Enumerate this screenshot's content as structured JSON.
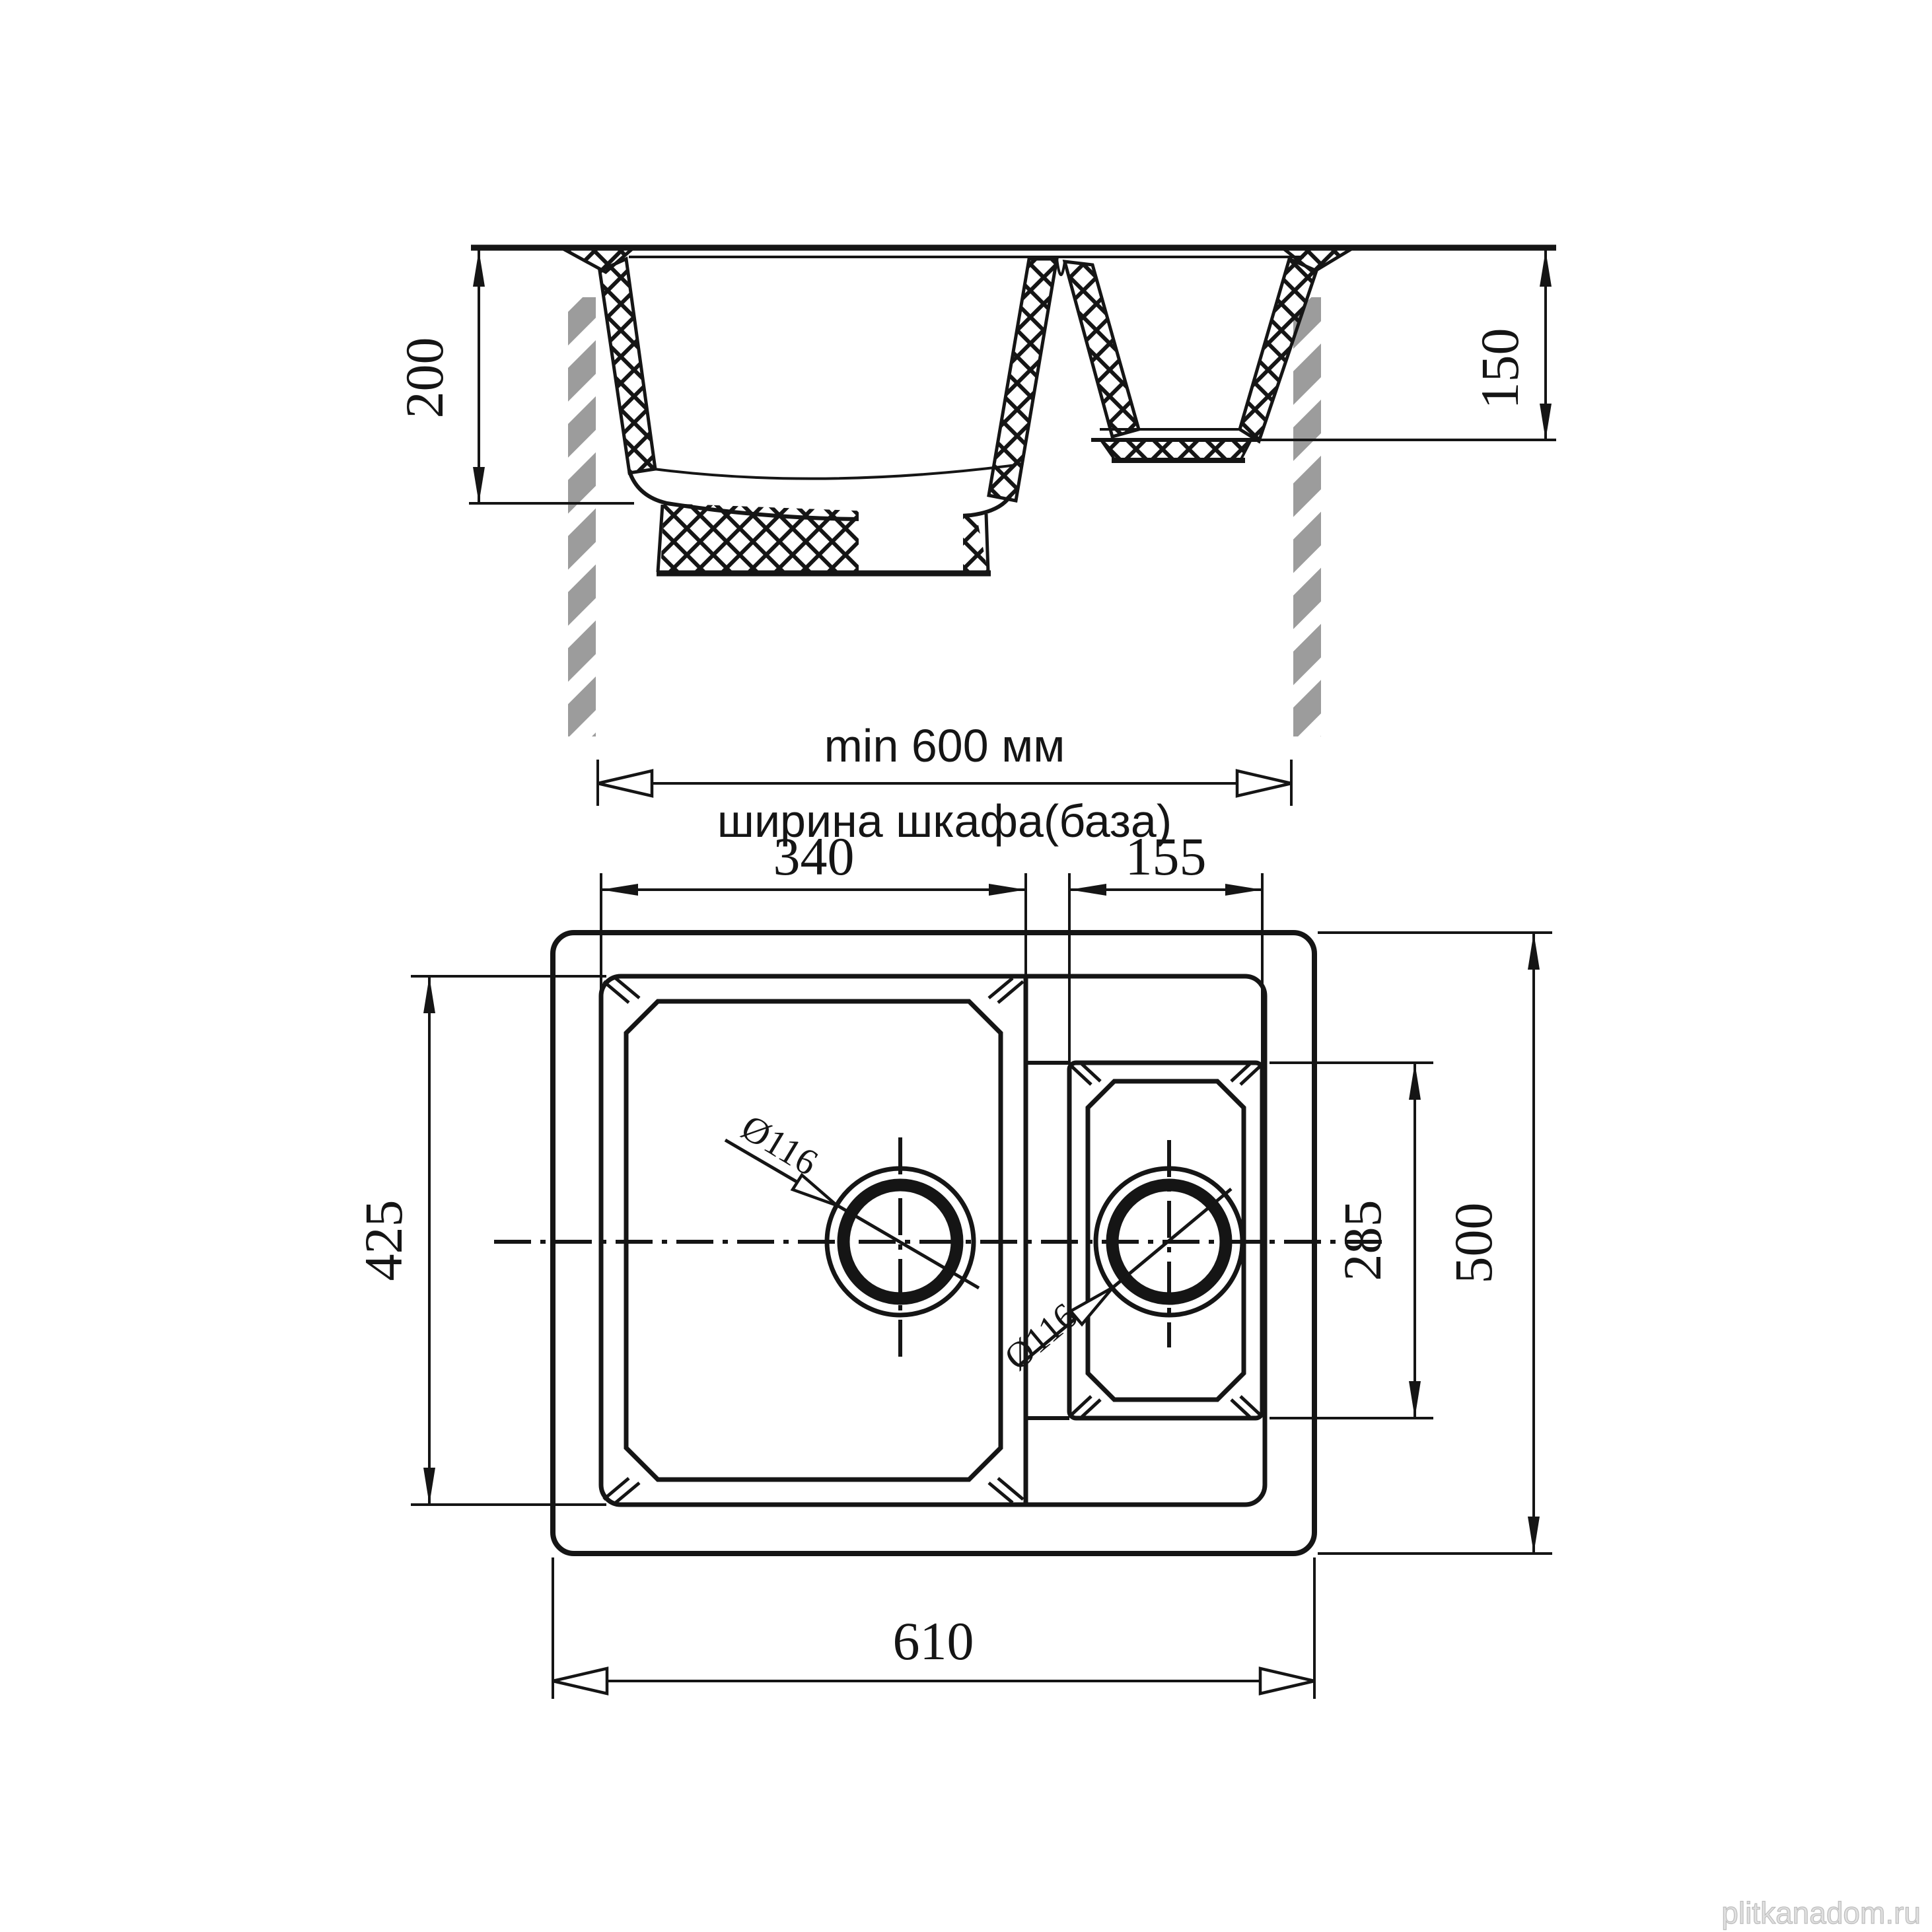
{
  "watermark": {
    "text": "plitkanadom.ru"
  },
  "section_view": {
    "depth_main_mm": "200",
    "depth_small_mm": "150",
    "cabinet_min_width": "min 600 мм",
    "cabinet_width_label": "ширина шкафа(база)"
  },
  "plan_view": {
    "main_bowl_width_mm": "340",
    "small_bowl_width_mm": "155",
    "main_bowl_depth_mm": "425",
    "overall_depth_mm": "500",
    "small_bowl_depth_mm": "285",
    "overall_width_mm": "610",
    "main_drain_diameter": "Ø116",
    "small_drain_diameter": "Ø116"
  },
  "colors": {
    "line": "#151515",
    "cabinet_wall_gray": "#9c9c9c",
    "watermark_gray": "#e0e0e0"
  }
}
